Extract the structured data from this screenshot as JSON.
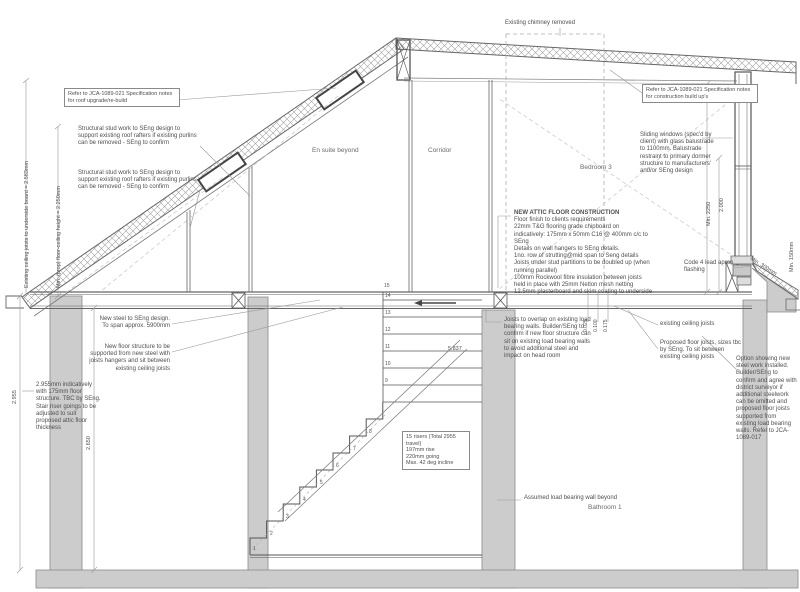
{
  "drawing": {
    "type": "architectural-section",
    "colors": {
      "wall_fill": "#cccccc",
      "line": "#666666",
      "thin_line": "#999999",
      "dashed": "#b0b0b0",
      "text": "#4f4f4f"
    }
  },
  "labels": {
    "ref_roof": "Refer to JCA-1089-021 Specification notes for roof upgrade/re-build",
    "stud_note_1": "Structural stud work to SEng design to support existing roof rafters if existing purlins can be removed - SEng to confirm",
    "stud_note_2": "Structural stud work to SEng design to support existing roof rafters if existing purlins can be removed - SEng to confirm",
    "chimney": "Existing chimney removed",
    "ref_construction": "Refer to JCA-1089-021 Specification notes for construction build up's",
    "sliding_windows": "Sliding windows (spec'd by client) with glass balustrade to 1100mm. Balustrade restraint to primary dormer structure to manufacturers' and/or SEng design",
    "lead_flashing": "Code 4 lead apron flashing",
    "existing_joists": "existing ceiling joists",
    "proposed_joists": "Proposed floor joists, sizes tbc by SEng. To sit between existing ceiling joists",
    "option_steel": "Option showing new steel work installed. Builder/SEng to confirm and agree with district surveyor if additional steelwork can be omitted and proposed floor joists supported from existing load bearing walls. Refer to JCA-1089-017",
    "new_steel": "New steel to SEng design. To span approx. 5900mm",
    "new_floor": "New floor structure to be supported from new steel with joists hangers and sit between existing ceiling joists",
    "left_wall_note": "2.955mm indicatively with 175mm floor structure. TBC by SEng. Stair riser goings to be adjusted to suit proposed attic floor thickness",
    "joists_overlap": "Joists to overlap on existing load bearing walls. Builder/SEng to confirm if new floor structure can sit on existing load bearing walls to avoid additional steel and impact on head room",
    "assumed_wall": "Assumed load bearing wall beyond"
  },
  "attic": {
    "title": "NEW ATTIC FLOOR CONSTRUCTION",
    "lines": [
      "Floor finish to clients requirements",
      "22mm T&G flooring grade chipboard on",
      "indicatively: 175mm x 50mm C16 @ 400mm c/c to SEng",
      "Details on wall hangers to SEng details.",
      "1no. row of strutting@mid span to Seng details",
      "Joists under stud partitions to be doubled up (when running parallel)",
      "100mm Rockwool fibre insulation between joists",
      "held in place with 25mm Netlon mesh netting",
      "12.5mm plasterboard and skim coating to underside"
    ]
  },
  "stair_note": {
    "lines": [
      "15 risers (Total 2955 travel)",
      "197mm rise",
      "220mm going",
      "Max. 42 deg incline"
    ]
  },
  "rooms": {
    "ensuite": "En suite beyond",
    "corridor": "Corridor",
    "bedroom3": "Bedroom 3",
    "bathroom1": "Bathroom 1"
  },
  "dims": {
    "existing_ceiling": "Existing ceiling joists to underside board = 2.583mm",
    "min_floor_ceiling": "Min. (prop) floor-ceiling height = 2.250mm",
    "min_2250": "Min. 2250",
    "d2000": "2.000",
    "min_150": "Min. 150mm",
    "min_300": "Min. 300mm",
    "d2955": "2.955",
    "d2650": "2.650",
    "d5837": "5.837",
    "d0025": "0.025",
    "d0100": "0.100",
    "d0175": "0.175"
  },
  "stairs": {
    "numbers": [
      "1",
      "2",
      "3",
      "4",
      "5",
      "6",
      "7",
      "8",
      "9",
      "10",
      "11",
      "12",
      "13",
      "14",
      "15"
    ]
  }
}
